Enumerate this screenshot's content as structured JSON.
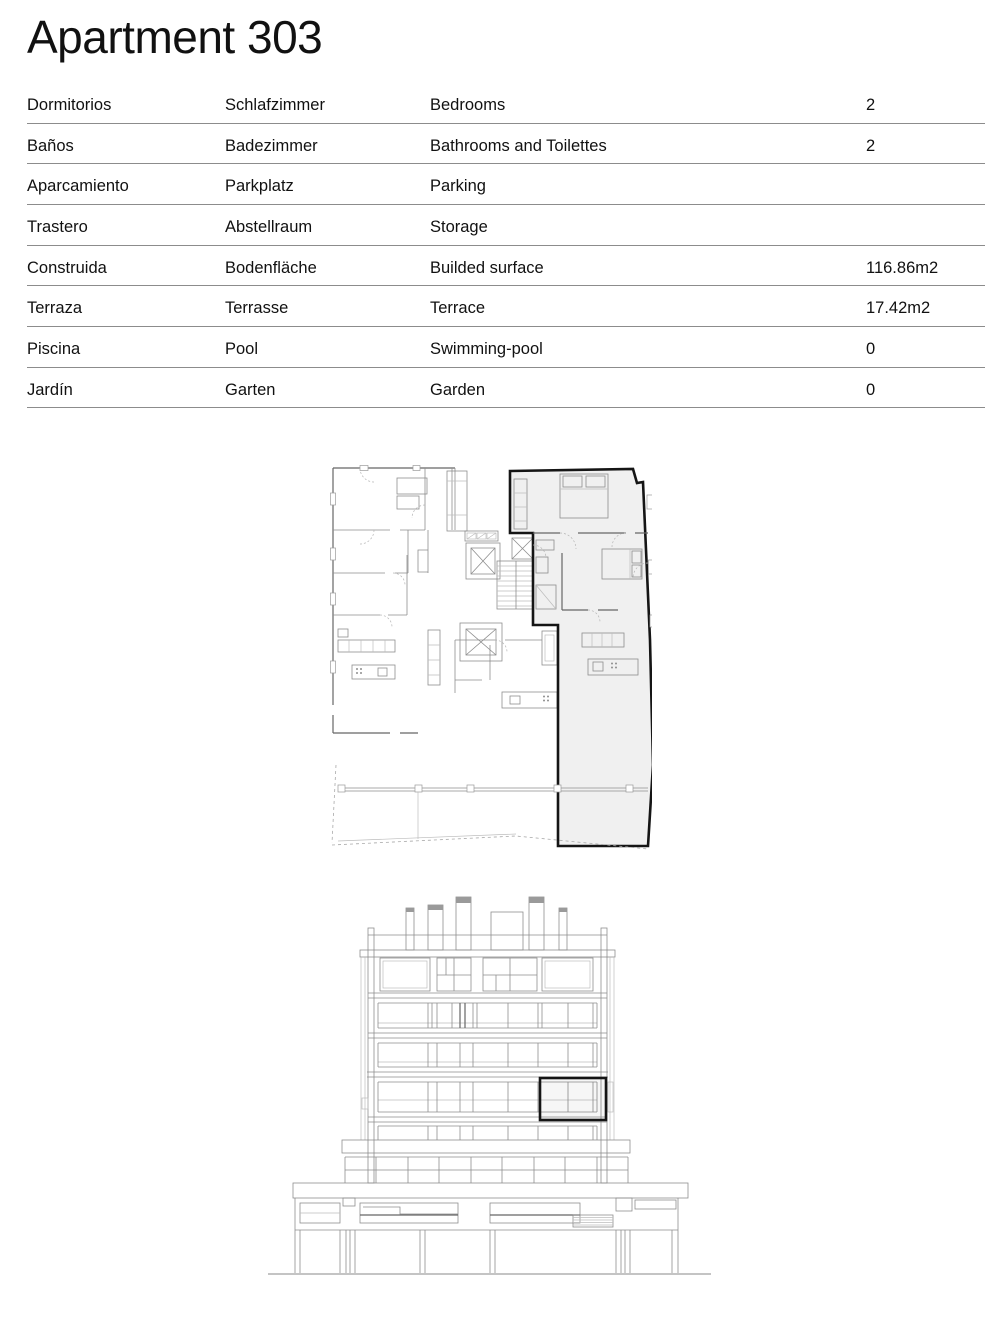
{
  "page_title": "Apartment 303",
  "table": {
    "rows": [
      {
        "es": "Dormitorios",
        "de": "Schlafzimmer",
        "en": "Bedrooms",
        "value": "2"
      },
      {
        "es": "Baños",
        "de": "Badezimmer",
        "en": "Bathrooms and Toilettes",
        "value": "2"
      },
      {
        "es": "Aparcamiento",
        "de": "Parkplatz",
        "en": "Parking",
        "value": ""
      },
      {
        "es": "Trastero",
        "de": "Abstellraum",
        "en": "Storage",
        "value": ""
      },
      {
        "es": "Construida",
        "de": "Bodenfläche",
        "en": "Builded surface",
        "value": "116.86m2"
      },
      {
        "es": "Terraza",
        "de": "Terrasse",
        "en": "Terrace",
        "value": "17.42m2"
      },
      {
        "es": "Piscina",
        "de": "Pool",
        "en": "Swimming-pool",
        "value": "0"
      },
      {
        "es": "Jardín",
        "de": "Garten",
        "en": "Garden",
        "value": "0"
      }
    ]
  },
  "colors": {
    "ink": "#111111",
    "rule": "#8c8c8c",
    "line_light": "#bdbdbd",
    "line_mid": "#8e8e8e",
    "line_dark": "#666666",
    "highlight": "#151515",
    "unit_fill": "#f0f0f0"
  }
}
